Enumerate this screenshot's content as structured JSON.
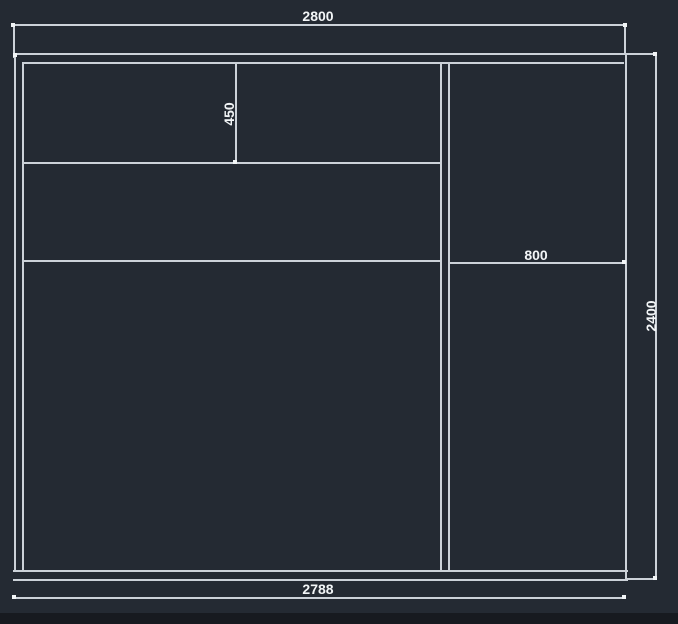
{
  "canvas": {
    "width": 678,
    "height": 624,
    "background": "#242a33",
    "bottom_bar_color": "#171a20"
  },
  "style": {
    "line_color": "#ccd2d9",
    "tick_color": "#f2f5f7",
    "text_color": "#f2f5f7"
  },
  "labels": [
    {
      "name": "dim-label-top-width",
      "text": "2800",
      "x": 318,
      "y": 16,
      "rotate": 0
    },
    {
      "name": "dim-label-upper-cubby-height",
      "text": "450",
      "x": 229,
      "y": 114,
      "rotate": -90
    },
    {
      "name": "dim-label-right-section-width",
      "text": "800",
      "x": 536,
      "y": 255,
      "rotate": 0
    },
    {
      "name": "dim-label-right-height",
      "text": "2400",
      "x": 651,
      "y": 316,
      "rotate": -90
    },
    {
      "name": "dim-label-bottom-width",
      "text": "2788",
      "x": 318,
      "y": 589,
      "rotate": 0
    }
  ],
  "segments": [
    {
      "name": "top-panel-outer-line",
      "x": 13,
      "y": 53,
      "w": 614,
      "h": 2
    },
    {
      "name": "top-panel-inner-line",
      "x": 22,
      "y": 62,
      "w": 602,
      "h": 2
    },
    {
      "name": "bottom-panel-upper-line",
      "x": 13,
      "y": 570,
      "w": 615,
      "h": 2
    },
    {
      "name": "bottom-panel-lower-line",
      "x": 13,
      "y": 579,
      "w": 615,
      "h": 2
    },
    {
      "name": "left-side-outer-line",
      "x": 14,
      "y": 53,
      "w": 2,
      "h": 519
    },
    {
      "name": "left-side-inner-line",
      "x": 22,
      "y": 62,
      "w": 2,
      "h": 510
    },
    {
      "name": "right-side-line",
      "x": 625,
      "y": 53,
      "w": 2,
      "h": 528
    },
    {
      "name": "center-divider-left-line",
      "x": 440,
      "y": 62,
      "w": 2,
      "h": 510
    },
    {
      "name": "center-divider-right-line",
      "x": 448,
      "y": 62,
      "w": 2,
      "h": 510
    },
    {
      "name": "upper-cubby-divider-line",
      "x": 235,
      "y": 62,
      "w": 2,
      "h": 102
    },
    {
      "name": "left-shelf-upper-line",
      "x": 23,
      "y": 162,
      "w": 418,
      "h": 2
    },
    {
      "name": "left-shelf-lower-line",
      "x": 23,
      "y": 260,
      "w": 418,
      "h": 2
    },
    {
      "name": "right-shelf-line",
      "x": 449,
      "y": 262,
      "w": 178,
      "h": 2
    },
    {
      "name": "dim-top-line",
      "x": 13,
      "y": 24,
      "w": 613,
      "h": 2
    },
    {
      "name": "dim-top-ext-left-line",
      "x": 13,
      "y": 24,
      "w": 2,
      "h": 34
    },
    {
      "name": "dim-top-ext-right-line",
      "x": 624,
      "y": 24,
      "w": 2,
      "h": 31
    },
    {
      "name": "dim-bottom-line",
      "x": 14,
      "y": 597,
      "w": 612,
      "h": 2
    },
    {
      "name": "dim-right-line",
      "x": 655,
      "y": 53,
      "w": 2,
      "h": 527
    },
    {
      "name": "dim-right-top-stub-line",
      "x": 627,
      "y": 53,
      "w": 30,
      "h": 2
    },
    {
      "name": "dim-right-bottom-stub-line",
      "x": 627,
      "y": 578,
      "w": 30,
      "h": 2
    }
  ],
  "ticks": [
    {
      "name": "dim-tick-top-left",
      "x": 11,
      "y": 23
    },
    {
      "name": "dim-tick-top-right",
      "x": 623,
      "y": 23
    },
    {
      "name": "corner-tick-top-left",
      "x": 13,
      "y": 53
    },
    {
      "name": "dim-tick-bottom-left",
      "x": 12,
      "y": 595
    },
    {
      "name": "dim-tick-bottom-right",
      "x": 622,
      "y": 595
    },
    {
      "name": "dim-tick-right-top",
      "x": 653,
      "y": 52
    },
    {
      "name": "dim-tick-right-bottom",
      "x": 653,
      "y": 576
    },
    {
      "name": "shelf-tick-right-end",
      "x": 622,
      "y": 260
    },
    {
      "name": "cubby-tick-bottom",
      "x": 233,
      "y": 160
    }
  ]
}
